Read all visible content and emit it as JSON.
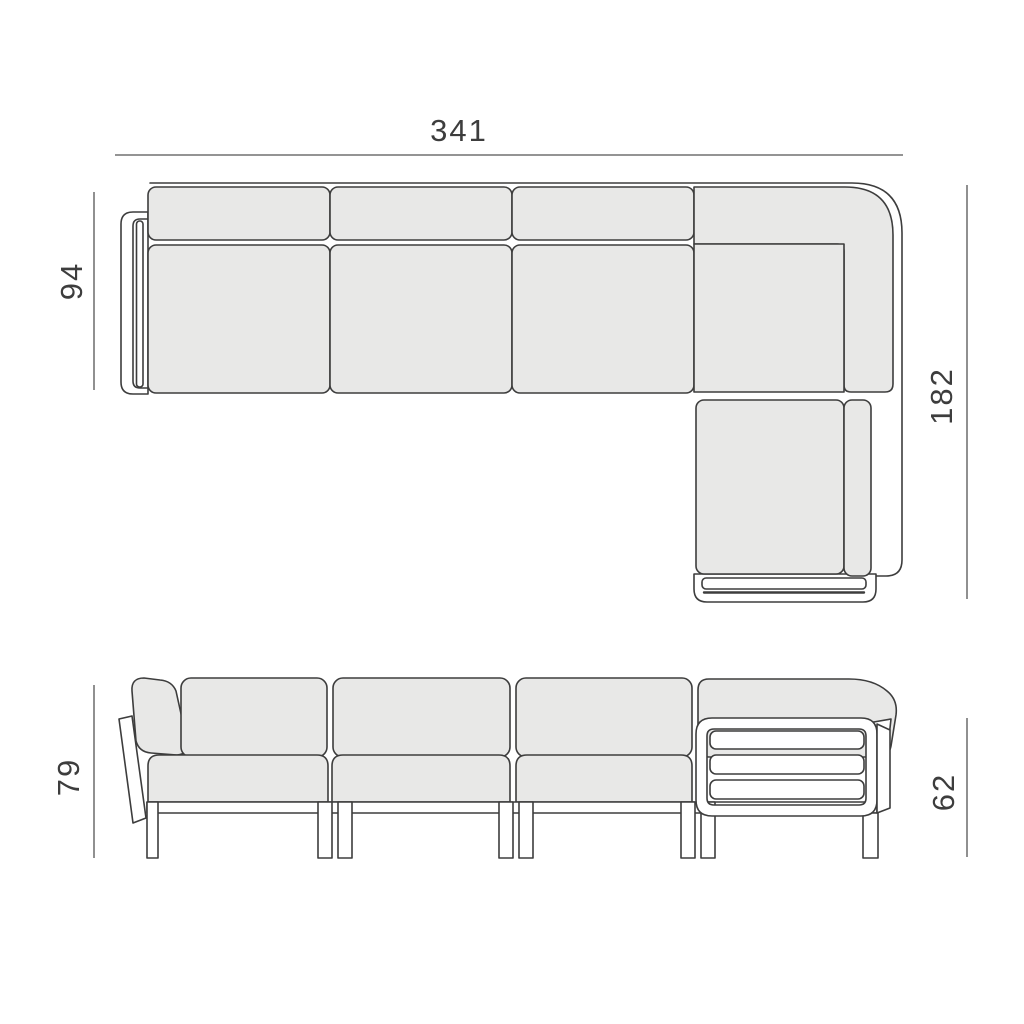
{
  "colors": {
    "background": "#ffffff",
    "cushion_fill": "#e8e8e7",
    "outline": "#3d3d3d",
    "dimension_line": "#555555",
    "label_text": "#3d3d3d"
  },
  "views": {
    "top": {
      "width_label": "341",
      "depth_label": "94",
      "corner_depth_label": "182"
    },
    "front": {
      "height_label": "79",
      "arm_height_label": "62"
    }
  },
  "values": {
    "overall_width": 341,
    "seat_depth": 94,
    "corner_depth": 182,
    "back_height": 79,
    "arm_height": 62
  }
}
